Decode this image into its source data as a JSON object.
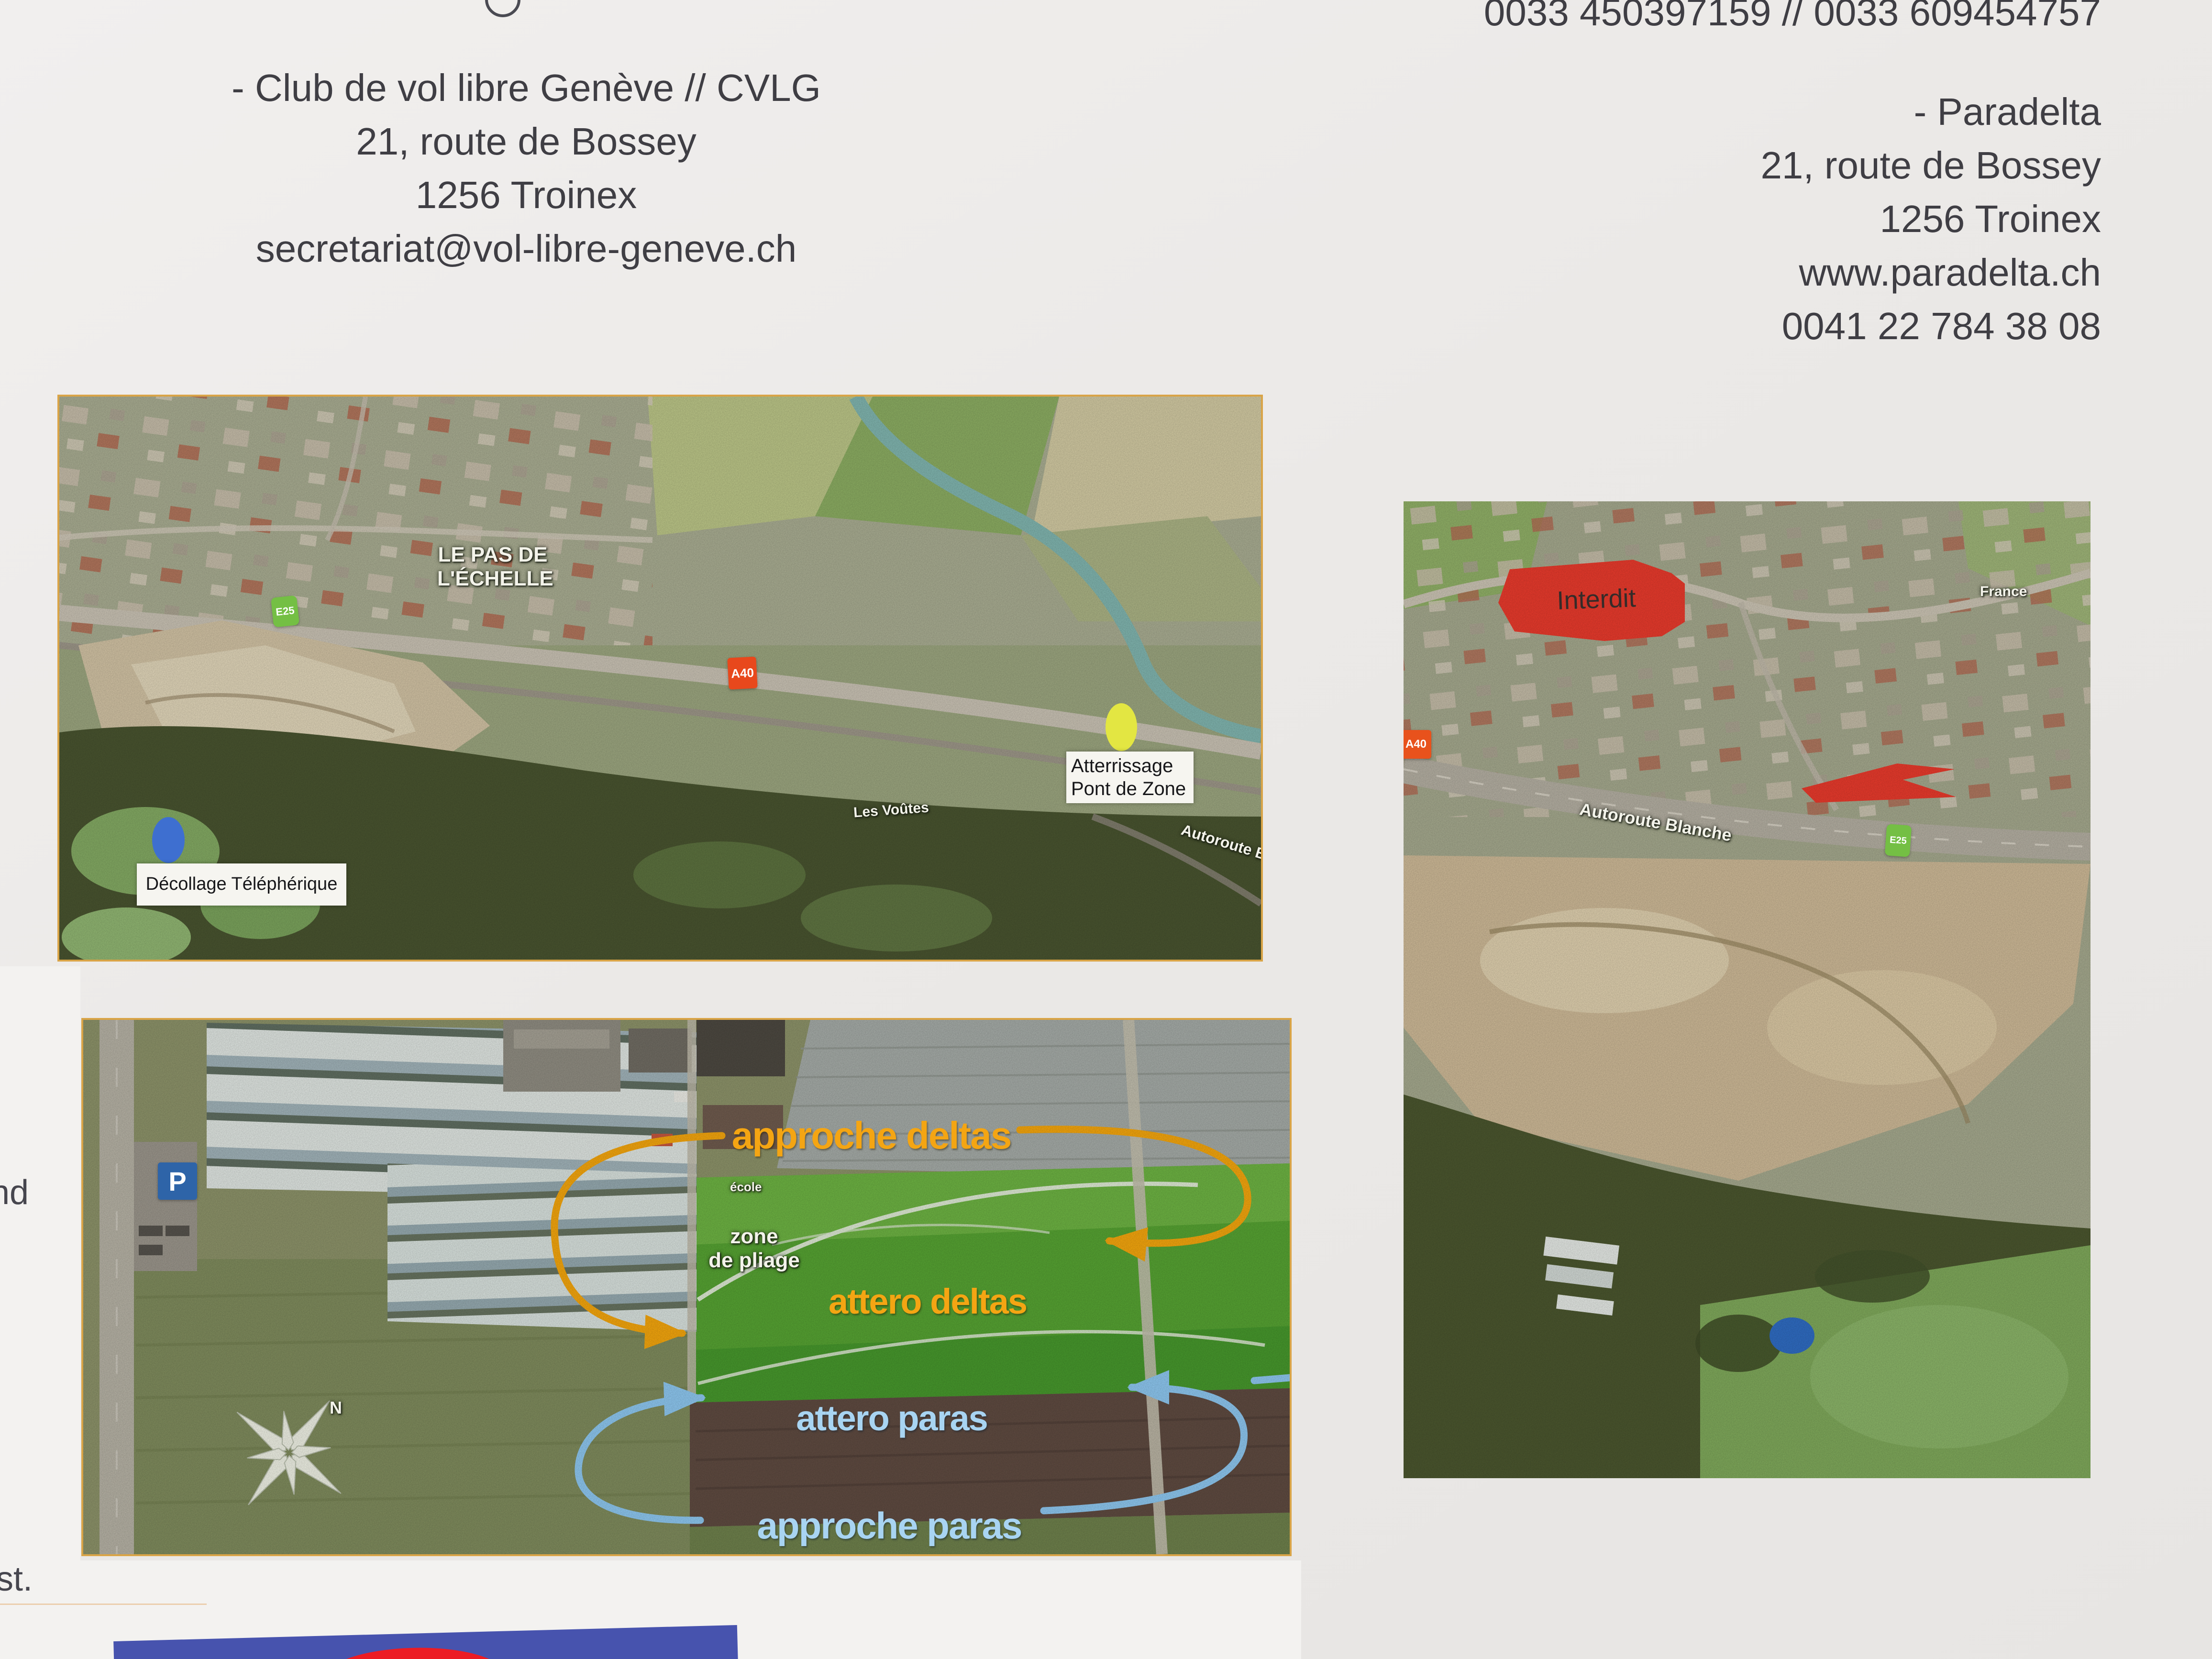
{
  "contacts": {
    "cvlg": {
      "lines": [
        "- Club de vol libre Genève // CVLG",
        "21, route de Bossey",
        "1256 Troinex",
        "secretariat@vol-libre-geneve.ch"
      ]
    },
    "paradelta": {
      "phone_line": "0033 450397159 // 0033 609454757",
      "lines": [
        "- Paradelta",
        "21, route de Bossey",
        "1256 Troinex",
        "www.paradelta.ch",
        "0041 22 784 38 08"
      ]
    }
  },
  "edge_fragments": {
    "top": "nd",
    "bottom": "st."
  },
  "overview_map": {
    "place_label": {
      "line1": "LE PAS DE",
      "line2": "L'ÉCHELLE"
    },
    "route_markers": {
      "e25": "E25",
      "a40": "A40"
    },
    "landing_label": {
      "line1": "Atterrissage",
      "line2": "Pont de Zone"
    },
    "takeoff_label": "Décollage Téléphérique",
    "les_voutes": "Les Voûtes",
    "autoroute": "Autoroute Blanche"
  },
  "restricted_map": {
    "interdit": "Interdit",
    "autoroute": "Autoroute Blanche",
    "e25": "E25",
    "a40": "A40",
    "france": "France"
  },
  "landing_map": {
    "approche_deltas": "approche deltas",
    "attero_deltas": "attero deltas",
    "attero_paras": "attero paras",
    "approche_paras": "approche paras",
    "zone_pliage": {
      "line1": "zone",
      "line2": "de pliage"
    },
    "ecole": "école",
    "parking": "P",
    "compass_north": "N"
  },
  "colors": {
    "orange_route": "#f1a40e",
    "blue_route": "#8cc5ed",
    "interdit_red": "#e63a2c",
    "marker_green": "#74bf44",
    "marker_red": "#e8481c",
    "dot_yellow": "#e3e642",
    "dot_blue": "#3e6fd0",
    "banner_blue": "#4753ae",
    "banner_red": "#ec1c24",
    "map_border": "#d9a447"
  }
}
